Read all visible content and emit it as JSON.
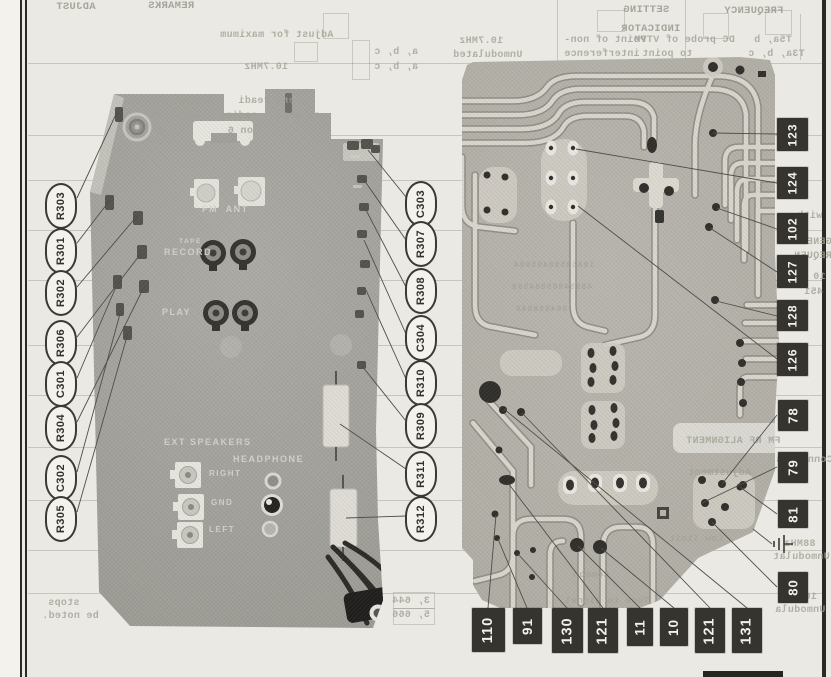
{
  "colors": {
    "page_bg": "#eae9e3",
    "rule": "#2b2a26",
    "photo_gray": "#a09f99",
    "pcb_gray": "#b1aea6",
    "trace_light": "#d8d5cc",
    "trace_edge": "#8f8d85",
    "callout_bg": "#f3f2ed",
    "callout_border": "#3b3935",
    "box_bg": "#35342f",
    "box_text": "#f2f1eb",
    "leader": "#504e48",
    "bleed_text": "#a3a195"
  },
  "figure_left": {
    "callouts_left": [
      "R303",
      "R301",
      "R302",
      "R306",
      "C301",
      "R304",
      "C302",
      "R305"
    ],
    "callouts_right": [
      "C303",
      "R307",
      "R308",
      "C304",
      "R310",
      "R309",
      "R311",
      "R312"
    ],
    "labels": {
      "fm_ant": "FM  ANT",
      "tape": "TAPE",
      "record": "RECORD",
      "play": "PLAY",
      "ext_speakers": "EXT SPEAKERS",
      "headphone": "HEADPHONE",
      "right": "RIGHT",
      "gnd": "GND",
      "left": "LEFT"
    }
  },
  "figure_right": {
    "callouts_side": [
      "123",
      "124",
      "102",
      "127",
      "128",
      "126",
      "78",
      "79",
      "81",
      "80"
    ],
    "callouts_bottom": [
      "110",
      "91",
      "130",
      "121",
      "11",
      "10",
      "121",
      "131"
    ],
    "ground_icon": "earth-ground-symbol"
  },
  "bleed": [
    "ADJUST",
    "REMARKS",
    "Adjust for maximum",
    "10.7MHz",
    "a, b, c",
    "a, b, c",
    "SETTING",
    "FREQUENCY",
    "INDICATOR",
    "10.7MHz",
    "Unmodulated",
    "Point of non-",
    "interference",
    "DC probe of VTVM",
    "to point",
    "T5a, b",
    "T3a, b, c",
    "s zero readi    A positive",
    "or nega   eading   obtained",
    "on 6          g.",
    "with",
    "GENERA",
    "FREQUEN",
    "10",
    "451",
    "FM RF ALIGNMENT",
    "Connect s",
    "Adjustment",
    "88MHz",
    "Unmodulat",
    "108MHz",
    "Unmodula",
    "stops",
    "be noted.",
    "3, 644",
    "5, 666"
  ],
  "pcb_bleed": [
    "Low limit",
    "Tune to signal",
    "Common"
  ],
  "pcb_texture": [
    "18854588485884",
    "48854885884588",
    "884858848"
  ]
}
